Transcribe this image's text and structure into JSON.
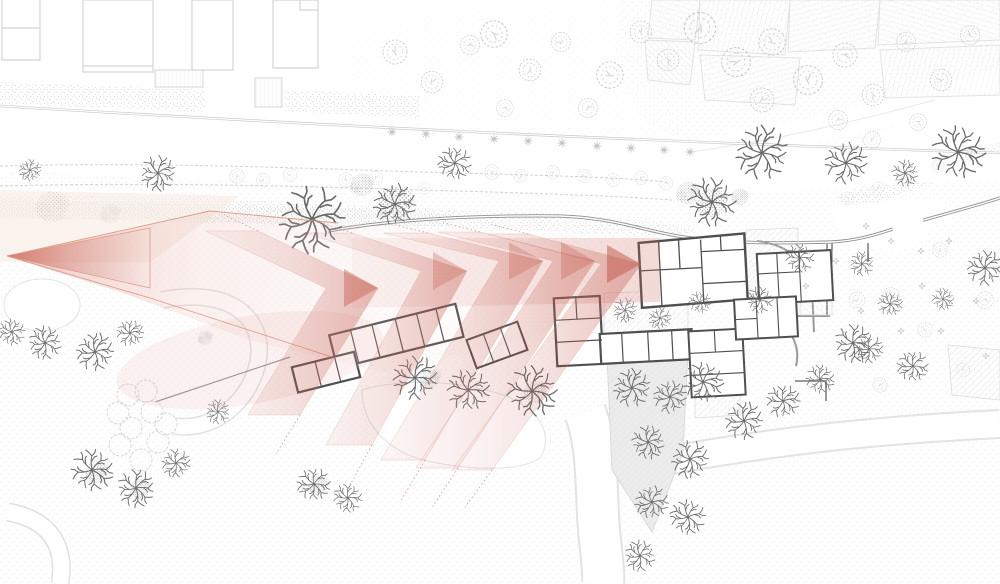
{
  "meta": {
    "type": "architectural-site-plan",
    "description": "Site plan drawing of a rural building ensemble with gardens, hedgerows and trees; a red fading chevron arrow sweeps from the left across the meadow and points at the main courtyard building cluster."
  },
  "colors": {
    "paper": "#ffffff",
    "arrow_red": "#c05648",
    "arrow_edge": "#db9480",
    "fan_pink": "#eec6bf",
    "wash_peach": "#f7e9e0",
    "wall_dark": "#4f4f4f",
    "wall_light": "#9a9a9a",
    "road_gray": "#8f8f8f",
    "faint_gray": "#d4d4d4",
    "stipple_gray": "#d6d6d6",
    "hatch_gray": "#dedede",
    "tree_dark": "#6a6a6a",
    "tree_light": "#c9c9c9",
    "shade_gray": "#ececec"
  },
  "arrow": {
    "vertex": [
      7,
      256
    ],
    "vertex_triangle": [
      [
        7,
        256
      ],
      [
        150,
        228
      ],
      [
        150,
        288
      ]
    ],
    "fan_outline": [
      [
        7,
        256
      ],
      [
        210,
        211
      ],
      [
        340,
        224
      ],
      [
        640,
        238
      ],
      [
        660,
        300
      ],
      [
        520,
        340
      ],
      [
        380,
        372
      ],
      [
        250,
        340
      ],
      [
        120,
        292
      ]
    ],
    "fan_top_edge": [
      [
        7,
        256
      ],
      [
        210,
        211
      ],
      [
        338,
        223
      ]
    ],
    "fan_bottom_edge": [
      [
        7,
        256
      ],
      [
        150,
        298
      ],
      [
        332,
        357
      ]
    ],
    "shaft": [
      [
        352,
        238
      ],
      [
        660,
        238
      ],
      [
        660,
        302
      ],
      [
        352,
        308
      ]
    ],
    "chevrons": [
      {
        "tip": [
          378,
          288
        ],
        "up": [
          258,
          231
        ],
        "down": [
          300,
          415
        ],
        "w": 52,
        "head": 0.42
      },
      {
        "tip": [
          467,
          271
        ],
        "up": [
          352,
          233
        ],
        "down": [
          372,
          445
        ],
        "w": 46,
        "head": 0.28
      },
      {
        "tip": [
          543,
          261
        ],
        "up": [
          428,
          233
        ],
        "down": [
          425,
          460
        ],
        "w": 44,
        "head": 0.28
      },
      {
        "tip": [
          595,
          261
        ],
        "up": [
          480,
          232
        ],
        "down": [
          458,
          468
        ],
        "w": 42,
        "head": 0.3
      },
      {
        "tip": [
          641,
          264
        ],
        "up": [
          528,
          234
        ],
        "down": [
          492,
          470
        ],
        "w": 40,
        "head": 0.5
      }
    ]
  },
  "vegetation": {
    "branchy": [
      [
        158,
        173,
        0.8
      ],
      [
        30,
        170,
        0.5
      ],
      [
        455,
        163,
        0.75
      ],
      [
        712,
        202,
        1.1
      ],
      [
        762,
        153,
        1.2
      ],
      [
        846,
        163,
        0.95
      ],
      [
        958,
        152,
        1.2
      ],
      [
        905,
        173,
        0.6
      ],
      [
        312,
        219,
        1.5
      ],
      [
        395,
        204,
        0.95
      ],
      [
        12,
        332,
        0.6
      ],
      [
        45,
        343,
        0.75
      ],
      [
        95,
        352,
        0.85
      ],
      [
        130,
        333,
        0.6
      ],
      [
        92,
        470,
        0.95
      ],
      [
        136,
        488,
        0.85
      ],
      [
        176,
        463,
        0.65
      ],
      [
        314,
        484,
        0.75
      ],
      [
        348,
        498,
        0.65
      ],
      [
        218,
        412,
        0.55
      ],
      [
        415,
        378,
        1.0
      ],
      [
        468,
        390,
        0.95
      ],
      [
        532,
        391,
        1.15
      ],
      [
        625,
        310,
        0.55
      ],
      [
        660,
        318,
        0.5
      ],
      [
        700,
        302,
        0.5
      ],
      [
        760,
        300,
        0.6
      ],
      [
        632,
        388,
        0.85
      ],
      [
        670,
        397,
        0.75
      ],
      [
        703,
        382,
        0.9
      ],
      [
        648,
        442,
        0.75
      ],
      [
        690,
        459,
        0.85
      ],
      [
        652,
        502,
        0.75
      ],
      [
        688,
        517,
        0.8
      ],
      [
        640,
        556,
        0.7
      ],
      [
        744,
        421,
        0.85
      ],
      [
        783,
        401,
        0.75
      ],
      [
        820,
        379,
        0.65
      ],
      [
        853,
        343,
        0.85
      ],
      [
        869,
        349,
        0.65
      ],
      [
        913,
        366,
        0.7
      ],
      [
        800,
        258,
        0.65
      ],
      [
        862,
        264,
        0.55
      ],
      [
        985,
        268,
        0.8
      ],
      [
        890,
        304,
        0.55
      ],
      [
        943,
        299,
        0.5
      ]
    ],
    "canopy": [
      [
        395,
        52,
        1.0
      ],
      [
        432,
        82,
        0.9
      ],
      [
        470,
        45,
        0.8
      ],
      [
        494,
        34,
        1.1
      ],
      [
        530,
        70,
        0.9
      ],
      [
        561,
        42,
        0.8
      ],
      [
        610,
        75,
        1.1
      ],
      [
        641,
        32,
        0.9
      ],
      [
        588,
        108,
        0.8
      ],
      [
        505,
        108,
        0.7
      ],
      [
        668,
        60,
        0.9
      ],
      [
        700,
        28,
        1.3
      ],
      [
        736,
        62,
        1.2
      ],
      [
        772,
        42,
        1.1
      ],
      [
        808,
        80,
        1.2
      ],
      [
        762,
        100,
        1.0
      ],
      [
        845,
        55,
        1.0
      ],
      [
        873,
        95,
        0.9
      ],
      [
        906,
        42,
        0.8
      ],
      [
        941,
        80,
        0.9
      ],
      [
        970,
        35,
        0.8
      ],
      [
        872,
        140,
        0.7
      ],
      [
        838,
        120,
        0.8
      ],
      [
        918,
        122,
        0.7
      ],
      [
        237,
        176,
        0.6
      ],
      [
        263,
        180,
        0.55
      ],
      [
        290,
        175,
        0.55
      ],
      [
        346,
        180,
        0.6
      ],
      [
        376,
        178,
        0.55
      ],
      [
        424,
        188,
        0.5
      ],
      [
        492,
        172,
        0.6
      ],
      [
        521,
        176,
        0.55
      ],
      [
        553,
        172,
        0.55
      ],
      [
        584,
        176,
        0.55
      ],
      [
        613,
        180,
        0.55
      ],
      [
        641,
        178,
        0.55
      ],
      [
        666,
        183,
        0.55
      ],
      [
        891,
        296,
        0.7
      ],
      [
        940,
        250,
        0.6
      ],
      [
        857,
        300,
        0.65
      ],
      [
        925,
        330,
        0.6
      ],
      [
        963,
        370,
        0.55
      ],
      [
        880,
        385,
        0.6
      ],
      [
        985,
        300,
        0.7
      ],
      [
        848,
        198,
        0.5
      ],
      [
        878,
        188,
        0.5
      ],
      [
        908,
        178,
        0.5
      ],
      [
        938,
        166,
        0.5
      ],
      [
        966,
        156,
        0.5
      ]
    ],
    "clump": [
      [
        52,
        207,
        1.1
      ],
      [
        110,
        214,
        0.7
      ],
      [
        395,
        203,
        1.2
      ],
      [
        362,
        185,
        0.8
      ],
      [
        688,
        193,
        0.8
      ],
      [
        712,
        203,
        1.0
      ],
      [
        740,
        197,
        0.6
      ],
      [
        97,
        472,
        0.8
      ],
      [
        140,
        489,
        0.7
      ],
      [
        318,
        486,
        0.7
      ],
      [
        205,
        338,
        0.5
      ],
      [
        535,
        392,
        0.8
      ],
      [
        430,
        378,
        0.7
      ]
    ],
    "circles": [
      [
        128,
        395
      ],
      [
        152,
        412
      ],
      [
        131,
        428
      ],
      [
        158,
        442
      ],
      [
        141,
        460
      ],
      [
        118,
        413
      ],
      [
        166,
        424
      ],
      [
        146,
        391
      ],
      [
        120,
        445
      ]
    ],
    "stars": [
      [
        392,
        132
      ],
      [
        426,
        134
      ],
      [
        459,
        137
      ],
      [
        494,
        139
      ],
      [
        528,
        141
      ],
      [
        562,
        143
      ],
      [
        597,
        146
      ],
      [
        631,
        148
      ],
      [
        664,
        150
      ],
      [
        690,
        152
      ]
    ],
    "flowers": [
      [
        866,
        226
      ],
      [
        891,
        241
      ],
      [
        921,
        251
      ],
      [
        949,
        241
      ],
      [
        836,
        261
      ],
      [
        976,
        301
      ],
      [
        901,
        331
      ],
      [
        861,
        311
      ],
      [
        941,
        331
      ],
      [
        986,
        356
      ],
      [
        806,
        286
      ],
      [
        922,
        286
      ]
    ]
  }
}
